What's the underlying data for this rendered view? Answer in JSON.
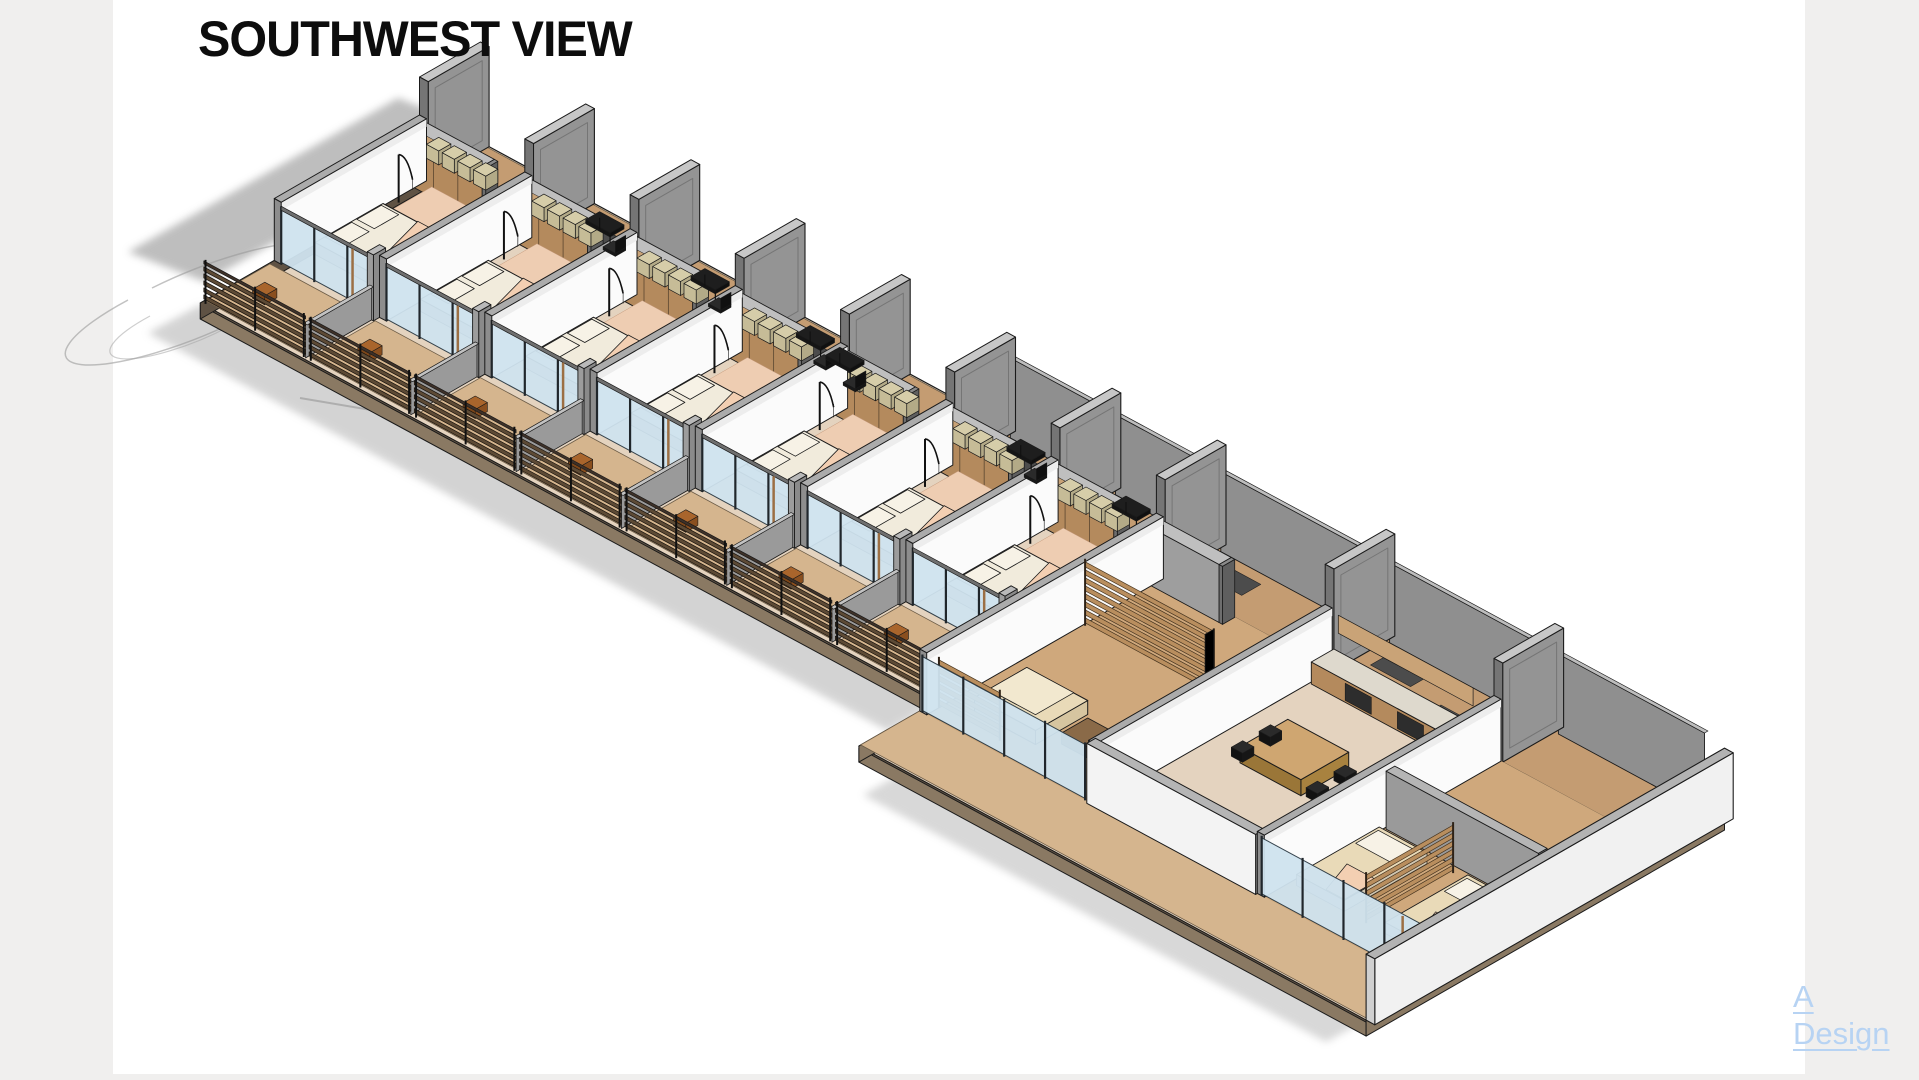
{
  "page": {
    "background_color": "#ffffff",
    "margin_color": "#f0efee",
    "left_margin_px": 113,
    "right_margin_px": 114,
    "bottom_strip_px": 6
  },
  "titleblock": {
    "view_label": "SOUTHWEST VIEW",
    "title_color": "#0d0d0d"
  },
  "watermark": {
    "line1": "A",
    "line2": "Design",
    "color": "#b7d3f3"
  },
  "scene": {
    "type": "axonometric-building-cutaway",
    "bedroom_bays": 7,
    "bay_width": 121,
    "common_bay_widths": [
      194,
      194,
      195
    ],
    "fin_heights": [
      100,
      95,
      96,
      94,
      95,
      94,
      95,
      100,
      102,
      99
    ],
    "palette": {
      "outline": "#1a1a1a",
      "wall_gray": "#949494",
      "wall_gray_top": "#c7c7c7",
      "wall_gray_dark": "#757575",
      "wall_white": "#fbfbfb",
      "wall_white_outer": "#f1f1f1",
      "slab_base": "#e4d3bf",
      "slab_edge": "#8a7963",
      "slab_edge_dark": "#5f5244",
      "corridor_floor": "#c49c72",
      "common_floor": "#cfa87c",
      "deck_floor": "#d5b58e",
      "wardrobe_wood": "#b48a5d",
      "wardrobe_wood_light": "#c9a377",
      "slat_wood": "#b98e5e",
      "slat_wood_dark": "#46341f",
      "railing_wood": "#5d4a35",
      "railing_cap": "#3e3128",
      "bed_duvet": "#f1ebdc",
      "bed_pillow": "#f7f2e6",
      "bed_peach": "#f3cfb2",
      "rug_peach": "#eecdb2",
      "shelf_khaki": "#d6cda9",
      "glass_blue": "#cfe3ef",
      "glass_frame": "#2b3a44",
      "door_frame_tan": "#9c6f44",
      "furniture_dark": "#1e1e1e",
      "mat_gray": "#565656",
      "rug_gray": "#4c4c4c",
      "stool_orange": "#a9652c",
      "sofa_cream": "#e9dab8",
      "sofa_cream_light": "#f2e8cf",
      "counter_top": "#ded9cd",
      "table_wood": "#cfa671",
      "shadow": "#a9a9a9"
    }
  }
}
